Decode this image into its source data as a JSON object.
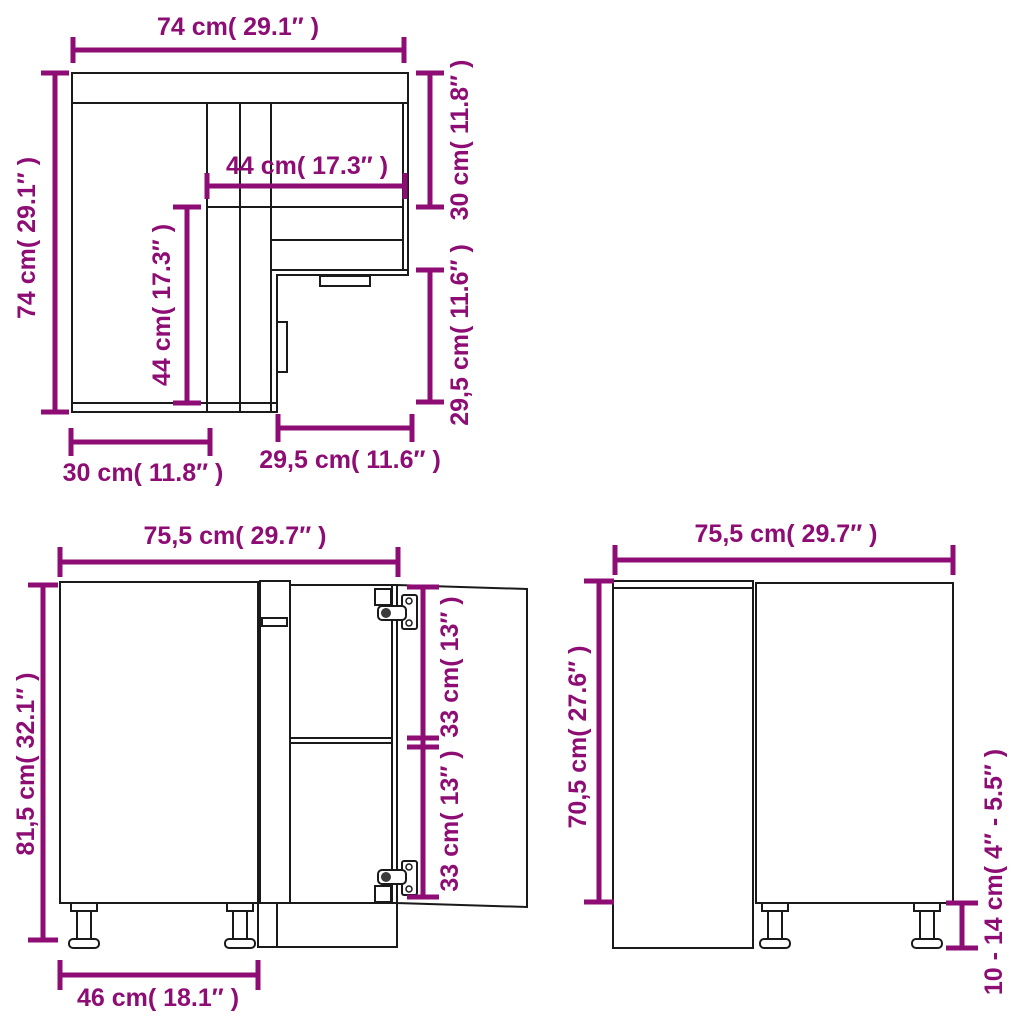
{
  "colors": {
    "dimension": "#8E0D74",
    "drawing": "#1a1a1a",
    "background": "#ffffff"
  },
  "diagram": {
    "subject": "corner kitchen base cabinet dimension drawing",
    "views": {
      "top": {
        "label": "top view (plan of corner carcass)",
        "dims": {
          "overall_width": "74 cm( 29.1″ )",
          "overall_depth": "74 cm( 29.1″ )",
          "inner_width": "44 cm( 17.3″ )",
          "inner_depth": "44 cm( 17.3″ )",
          "right_section_depth": "30 cm( 11.8″ )",
          "right_cutout_depth": "29,5 cm( 11.6″ )",
          "bottom_left_width": "30 cm( 11.8″ )",
          "bottom_cutout_width": "29,5 cm( 11.6″ )"
        }
      },
      "front": {
        "label": "front view (door open)",
        "dims": {
          "overall_width": "75,5 cm( 29.7″ )",
          "overall_height": "81,5 cm( 32.1″ )",
          "upper_opening_height": "33 cm( 13″ )",
          "lower_opening_height": "33 cm( 13″ )",
          "door_width": "46 cm( 18.1″ )"
        }
      },
      "side": {
        "label": "side view",
        "dims": {
          "overall_depth": "75,5 cm( 29.7″ )",
          "body_height": "70,5 cm( 27.6″ )",
          "leg_height": "10 - 14 cm( 4″ - 5.5″ )"
        }
      }
    }
  }
}
